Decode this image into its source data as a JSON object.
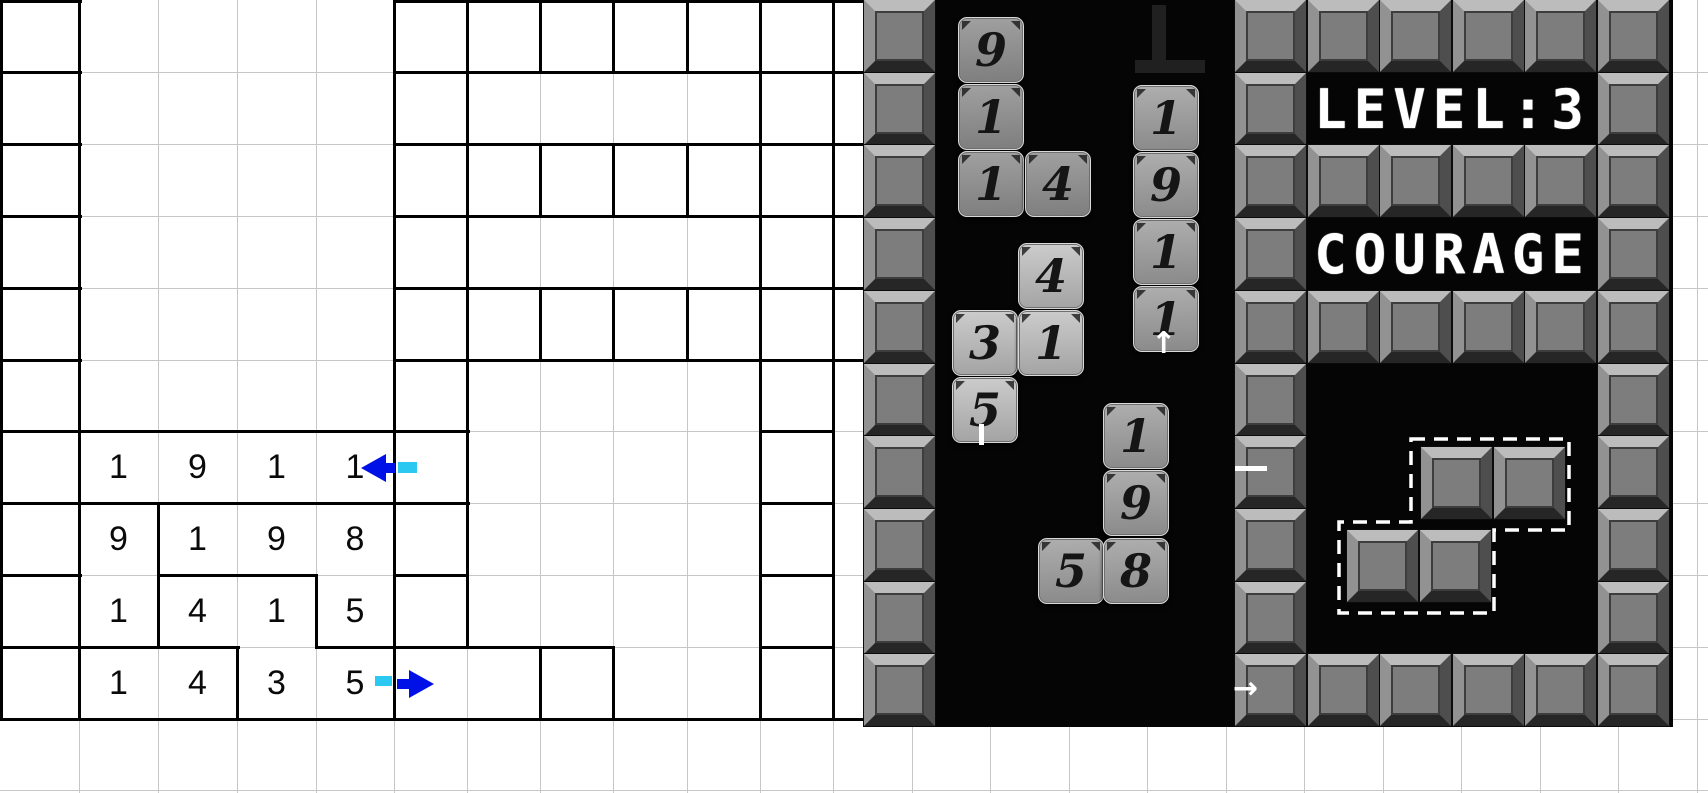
{
  "left_grid": {
    "gray_color": "#c7c7c7",
    "black_color": "#000000",
    "row_step": 71.9,
    "col_edges": [
      0,
      79,
      158,
      237,
      316,
      394,
      467,
      540,
      613,
      687,
      760,
      833
    ],
    "extra_vertical_lines": [
      912,
      990,
      1069,
      1147,
      1226,
      1304,
      1383,
      1461,
      1540,
      1618,
      1697
    ],
    "horizontal_lines": [
      72,
      144,
      216,
      288,
      360,
      431,
      503,
      575,
      647,
      719,
      790
    ],
    "black_v": [
      [
        0,
        0,
        719
      ],
      [
        79,
        0,
        719
      ],
      [
        158,
        503,
        647
      ],
      [
        237,
        647,
        719
      ],
      [
        316,
        575,
        647
      ],
      [
        394,
        0,
        719
      ],
      [
        467,
        0,
        647
      ],
      [
        540,
        0,
        72
      ],
      [
        540,
        144,
        216
      ],
      [
        540,
        288,
        360
      ],
      [
        540,
        647,
        719
      ],
      [
        613,
        0,
        72
      ],
      [
        613,
        144,
        216
      ],
      [
        613,
        288,
        360
      ],
      [
        613,
        647,
        719
      ],
      [
        687,
        0,
        72
      ],
      [
        687,
        144,
        216
      ],
      [
        687,
        288,
        360
      ],
      [
        760,
        0,
        719
      ],
      [
        833,
        0,
        719
      ]
    ],
    "black_h": [
      [
        0,
        0,
        79
      ],
      [
        0,
        394,
        863
      ],
      [
        72,
        0,
        79
      ],
      [
        72,
        394,
        863
      ],
      [
        144,
        0,
        79
      ],
      [
        144,
        394,
        863
      ],
      [
        216,
        0,
        79
      ],
      [
        216,
        394,
        863
      ],
      [
        288,
        0,
        79
      ],
      [
        288,
        394,
        863
      ],
      [
        360,
        0,
        79
      ],
      [
        360,
        394,
        863
      ],
      [
        431,
        0,
        467
      ],
      [
        431,
        760,
        833
      ],
      [
        503,
        0,
        467
      ],
      [
        503,
        760,
        833
      ],
      [
        575,
        0,
        79
      ],
      [
        575,
        158,
        316
      ],
      [
        575,
        394,
        467
      ],
      [
        575,
        760,
        833
      ],
      [
        647,
        0,
        237
      ],
      [
        647,
        316,
        613
      ],
      [
        647,
        760,
        833
      ],
      [
        719,
        0,
        863
      ]
    ],
    "numbers": [
      {
        "row": 6,
        "col": 1,
        "value": "1"
      },
      {
        "row": 6,
        "col": 2,
        "value": "9"
      },
      {
        "row": 6,
        "col": 3,
        "value": "1"
      },
      {
        "row": 6,
        "col": 4,
        "value": "1"
      },
      {
        "row": 7,
        "col": 1,
        "value": "9"
      },
      {
        "row": 7,
        "col": 2,
        "value": "1"
      },
      {
        "row": 7,
        "col": 3,
        "value": "9"
      },
      {
        "row": 7,
        "col": 4,
        "value": "8"
      },
      {
        "row": 8,
        "col": 1,
        "value": "1"
      },
      {
        "row": 8,
        "col": 2,
        "value": "4"
      },
      {
        "row": 8,
        "col": 3,
        "value": "1"
      },
      {
        "row": 8,
        "col": 4,
        "value": "5"
      },
      {
        "row": 9,
        "col": 1,
        "value": "1"
      },
      {
        "row": 9,
        "col": 2,
        "value": "4"
      },
      {
        "row": 9,
        "col": 3,
        "value": "3"
      },
      {
        "row": 9,
        "col": 4,
        "value": "5"
      }
    ],
    "arrow_blue": "#0011e8",
    "arrow_cyan": "#2bc9f1"
  },
  "game": {
    "hud": {
      "level_text": "LEVEL:3",
      "motto_text": "COURAGE",
      "text_color": "#ffffff"
    },
    "tile_size": 66,
    "tiles": [
      {
        "v": "9",
        "x": 95,
        "y": 17,
        "tone": "dark"
      },
      {
        "v": "1",
        "x": 95,
        "y": 84,
        "tone": "dark"
      },
      {
        "v": "1",
        "x": 95,
        "y": 151,
        "tone": "dark"
      },
      {
        "v": "4",
        "x": 162,
        "y": 151,
        "tone": "dark"
      },
      {
        "v": "4",
        "x": 155,
        "y": 243,
        "tone": "light"
      },
      {
        "v": "3",
        "x": 89,
        "y": 310,
        "tone": "light"
      },
      {
        "v": "1",
        "x": 155,
        "y": 310,
        "tone": "light"
      },
      {
        "v": "5",
        "x": 89,
        "y": 377,
        "tone": "light"
      },
      {
        "v": "1",
        "x": 270,
        "y": 85,
        "tone": "mid"
      },
      {
        "v": "9",
        "x": 270,
        "y": 152,
        "tone": "mid"
      },
      {
        "v": "1",
        "x": 270,
        "y": 219,
        "tone": "mid"
      },
      {
        "v": "1",
        "x": 270,
        "y": 286,
        "tone": "mid"
      },
      {
        "v": "1",
        "x": 240,
        "y": 403,
        "tone": "mid"
      },
      {
        "v": "9",
        "x": 240,
        "y": 470,
        "tone": "mid"
      },
      {
        "v": "5",
        "x": 175,
        "y": 538,
        "tone": "mid"
      },
      {
        "v": "8",
        "x": 240,
        "y": 538,
        "tone": "mid"
      }
    ],
    "wall": {
      "block_w": 71,
      "row_step": 72.7,
      "col_step": 72.6,
      "left_column": {
        "x": 1,
        "rows": 10
      },
      "right_section_x0": 372,
      "right_cells": [
        [
          0,
          0
        ],
        [
          1,
          0
        ],
        [
          2,
          0
        ],
        [
          3,
          0
        ],
        [
          4,
          0
        ],
        [
          5,
          0
        ],
        [
          0,
          1
        ],
        [
          5,
          1
        ],
        [
          0,
          2
        ],
        [
          1,
          2
        ],
        [
          2,
          2
        ],
        [
          3,
          2
        ],
        [
          4,
          2
        ],
        [
          5,
          2
        ],
        [
          0,
          3
        ],
        [
          5,
          3
        ],
        [
          0,
          4
        ],
        [
          1,
          4
        ],
        [
          2,
          4
        ],
        [
          3,
          4
        ],
        [
          4,
          4
        ],
        [
          5,
          4
        ],
        [
          0,
          5
        ],
        [
          5,
          5
        ],
        [
          0,
          6
        ],
        [
          5,
          6
        ],
        [
          0,
          7
        ],
        [
          5,
          7
        ],
        [
          0,
          8
        ],
        [
          5,
          8
        ],
        [
          0,
          9
        ],
        [
          1,
          9
        ],
        [
          2,
          9
        ],
        [
          3,
          9
        ],
        [
          4,
          9
        ],
        [
          5,
          9
        ]
      ]
    },
    "falling_piece": {
      "blocks": [
        [
          558,
          447
        ],
        [
          631,
          447
        ],
        [
          484,
          530
        ],
        [
          557,
          530
        ]
      ],
      "outline_points": "548,439 706,439 706,530 631,530 631,613 476,613 476,522 548,522"
    },
    "marks": {
      "dash_h": {
        "x": 372,
        "y": 466,
        "w": 32,
        "h": 5
      },
      "dash_v": {
        "x": 116,
        "y": 424,
        "w": 5,
        "h": 21
      },
      "arrow_up_glyph": "↑",
      "arrow_right_glyph": "→",
      "arrow_up": {
        "x": 288,
        "y": 329
      },
      "arrow_right": {
        "x": 370,
        "y": 674
      },
      "cross_h": {
        "x": 272,
        "y": 60,
        "w": 70,
        "h": 13
      },
      "cross_v": {
        "x": 289,
        "y": 5,
        "w": 14,
        "h": 68
      }
    }
  }
}
